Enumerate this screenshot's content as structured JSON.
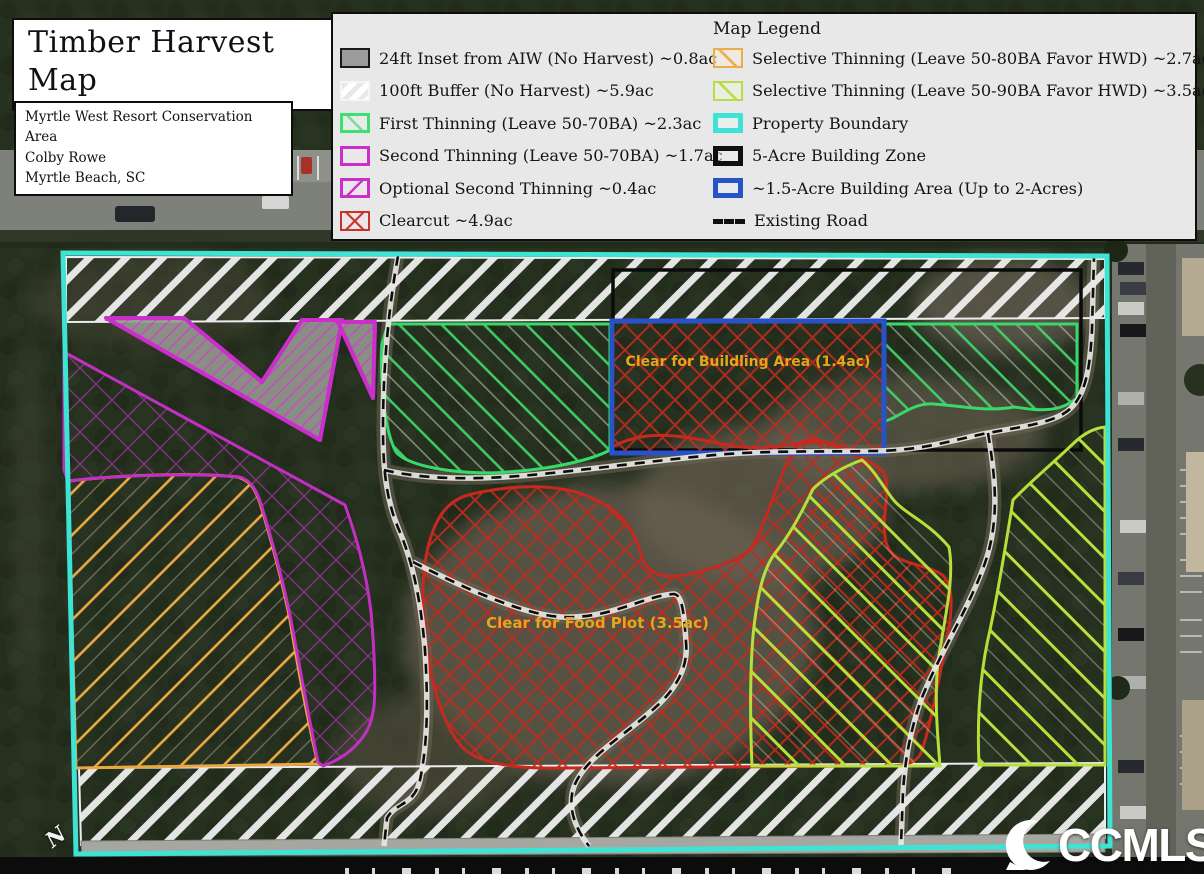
{
  "header": {
    "title": "Timber Harvest Map"
  },
  "info": {
    "line1": "Myrtle West Resort Conservation Area",
    "line2": "Colby Rowe",
    "line3": "Myrtle Beach, SC"
  },
  "legend": {
    "title": "Map Legend",
    "left": [
      {
        "swatch": "gray-fill",
        "label": "24ft Inset from AIW (No Harvest) ~0.8ac"
      },
      {
        "swatch": "white-hatch",
        "label": "100ft Buffer (No Harvest) ~5.9ac"
      },
      {
        "swatch": "green-hatch",
        "label": "First Thinning (Leave 50-70BA) ~2.3ac"
      },
      {
        "swatch": "magenta-outline",
        "label": "Second Thinning (Leave 50-70BA) ~1.7ac"
      },
      {
        "swatch": "magenta-hatch",
        "label": "Optional Second Thinning ~0.4ac"
      },
      {
        "swatch": "red-crosshatch",
        "label": "Clearcut ~4.9ac"
      }
    ],
    "right": [
      {
        "swatch": "orange-hatch",
        "label": "Selective Thinning (Leave 50-80BA Favor HWD) ~2.7ac"
      },
      {
        "swatch": "yellowgreen-hatch",
        "label": "Selective Thinning (Leave 50-90BA Favor HWD) ~3.5ac"
      },
      {
        "swatch": "cyan-outline",
        "label": "Property Boundary"
      },
      {
        "swatch": "black-outline",
        "label": "5-Acre Building Zone"
      },
      {
        "swatch": "blue-outline",
        "label": "~1.5-Acre Building Area (Up to 2-Acres)"
      },
      {
        "swatch": "dashed-line",
        "label": "Existing Road"
      }
    ]
  },
  "map_labels": {
    "building_area": "Clear for Buildling Area (1.4ac)",
    "food_plot": "Clear for Food Plot (3.5ac)",
    "north": "N"
  },
  "watermark": {
    "text": "CCMLS"
  },
  "colors": {
    "property_boundary": "#3FE3D3",
    "building_zone": "#0B0B0B",
    "building_area": "#2A52C8",
    "clearcut": "#C8291E",
    "first_thinning": "#38D86A",
    "second_thinning": "#C22FC2",
    "selective_50_80": "#E9A843",
    "selective_50_90": "#B6DF3C",
    "buffer_hatch": "#EEEEEE",
    "aiw_inset": "#A7A7A2",
    "map_label_text": "#E8A51B"
  }
}
